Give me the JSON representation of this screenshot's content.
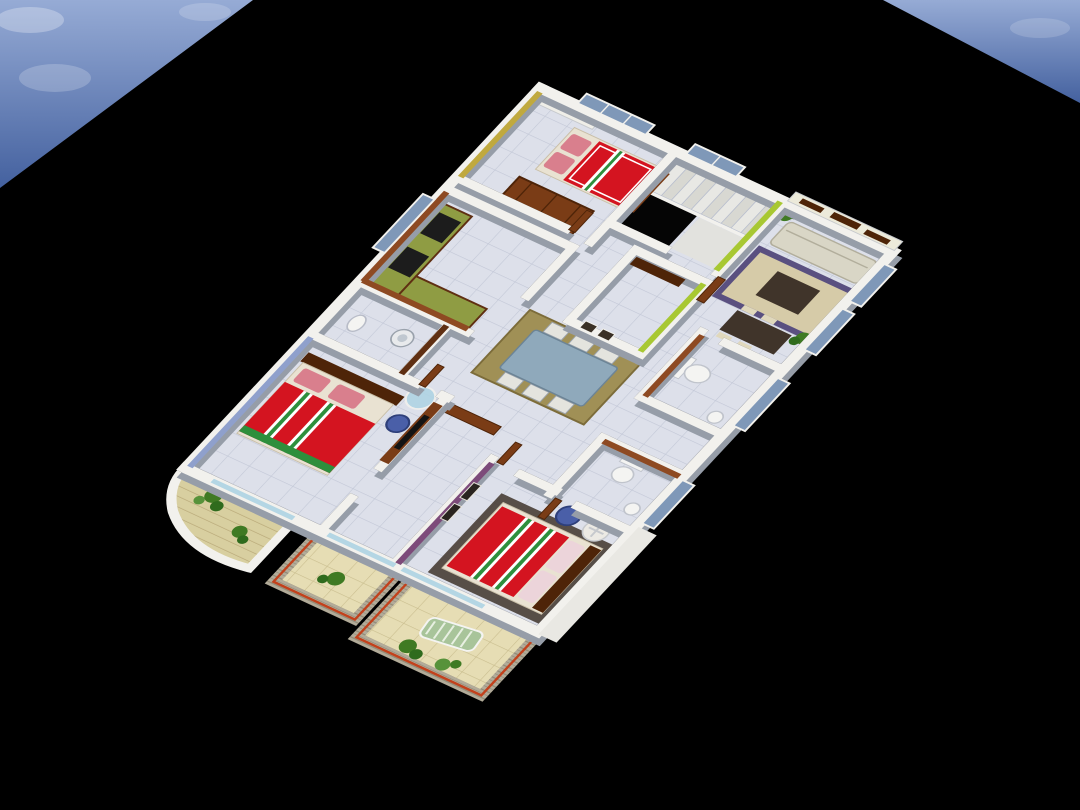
{
  "scene": {
    "type": "3d-floor-plan-render",
    "description": "Isometric 3D cutaway render of a multi-room apartment floor plan viewed from above, placed on a black ground plane with blue sky visible in the top corners",
    "view": "aerial-isometric",
    "background": "black ground plane",
    "sky_corners": [
      "top-left",
      "top-right"
    ]
  },
  "colors": {
    "ground": "#000000",
    "skyTop": "#8fa6d2",
    "skyBottom": "#44619f",
    "cloud": "#ffffff",
    "wall": "#f2f1ed",
    "wallShadow": "#969da8",
    "wallSide": "#c6c9cd",
    "floorTile": "#dde0ea",
    "tileLine": "#c2c7d6",
    "balconyFloor": "#e6ddb4",
    "balconyLine": "#c9bd8e",
    "slat": "#b2ab99",
    "trim": "#c2411c",
    "terracotta": "#8e4a22",
    "terracottaDark": "#5f2f12",
    "olive": "#c0a93e",
    "lime": "#a8c832",
    "purple": "#7d4b7a",
    "blueWall": "#8fa0cc",
    "bedRed": "#d41420",
    "stripeGreen": "#2e8f3c",
    "pillowPink": "#d97f8d",
    "wood": "#7a3c16",
    "woodDark": "#4e2408",
    "sofa": "#d9d6c6",
    "tableDark": "#40342a",
    "rugLiving": "#d6cba8",
    "rugBorder": "#5a5080",
    "rugDining": "#a09056",
    "diningTable": "#8fa9bb",
    "glass": "#aed4e4",
    "windowGlass": "#7f98b8",
    "plant": "#3f7a23",
    "plantDark": "#2f6b1d",
    "ottoman": "#4a5fa8",
    "ceramic": "#f4f4f2",
    "stairTread": "#e8e8e4",
    "stairAlt": "#d8d8d2",
    "void": "#050505",
    "slatWall": "#eceada",
    "tallWall": "#e9e8e3",
    "deckWood": "#d8cfa0"
  },
  "rooms": [
    {
      "id": "bedroom-1",
      "label": "Bedroom 1 (top)",
      "accent": "olive-gold wall, red double bed"
    },
    {
      "id": "stairwell",
      "label": "Staircase with open well",
      "accent": "lime green wall, white steps"
    },
    {
      "id": "living-room",
      "label": "Living room",
      "accent": "cream sofa, wood wall shelves, patterned rug"
    },
    {
      "id": "kitchen",
      "label": "Kitchen",
      "accent": "terracotta walls, L-counter with cooktops"
    },
    {
      "id": "store-room",
      "label": "Store / puja room",
      "accent": "lime green outer wall, wall shelf"
    },
    {
      "id": "hallway-dining",
      "label": "Hallway and dining",
      "accent": "glass-top table, six chairs, console"
    },
    {
      "id": "common-bathroom",
      "label": "Common bathroom",
      "accent": "terracotta walls, toilet and basin"
    },
    {
      "id": "utility-bathroom",
      "label": "Utility bathroom",
      "accent": "washing machine, toilet"
    },
    {
      "id": "bedroom-2",
      "label": "Bedroom 2 (left)",
      "accent": "blue wall, wood TV panel, red bed"
    },
    {
      "id": "bedroom-3",
      "label": "Bedroom 3 (bottom)",
      "accent": "purple wall with framed art, red bed"
    },
    {
      "id": "ensuite-bathroom",
      "label": "En-suite bathroom",
      "accent": "terracotta wall, toilet"
    },
    {
      "id": "balcony-curved",
      "label": "Curved balcony",
      "accent": "wood deck, plants"
    },
    {
      "id": "balcony-small",
      "label": "Small balcony",
      "accent": "slatted railing, plant"
    },
    {
      "id": "balcony-large",
      "label": "Large balcony",
      "accent": "slatted railing, lounger, plants"
    }
  ],
  "furniture": [
    {
      "id": "double-bed",
      "count": 3,
      "label": "red double beds with striped runners and pink pillows"
    },
    {
      "id": "sofa",
      "count": 1,
      "label": "cream three-seat sofa"
    },
    {
      "id": "coffee-table",
      "count": 2,
      "label": "dark wood low tables"
    },
    {
      "id": "dining-set",
      "count": 1,
      "label": "glass dining table with six chairs"
    },
    {
      "id": "kitchen-counter",
      "count": 2,
      "label": "green-top counters with black cooktops"
    },
    {
      "id": "fridge",
      "count": 1,
      "label": "refrigerator"
    },
    {
      "id": "washing-machine",
      "count": 1,
      "label": "washing machine"
    },
    {
      "id": "toilet",
      "count": 3,
      "label": "white toilets"
    },
    {
      "id": "round-table",
      "count": 2,
      "label": "round side tables"
    },
    {
      "id": "ottoman",
      "count": 2,
      "label": "round blue ottomans"
    },
    {
      "id": "tv-panel",
      "count": 1,
      "label": "wooden TV panel"
    },
    {
      "id": "console-table",
      "count": 1,
      "label": "hall console with framed pictures"
    },
    {
      "id": "wall-shelves",
      "count": 1,
      "label": "decorative wooden wall shelves"
    },
    {
      "id": "lounger",
      "count": 1,
      "label": "green balcony lounger"
    },
    {
      "id": "plants",
      "count": 5,
      "label": "potted green plants"
    }
  ]
}
